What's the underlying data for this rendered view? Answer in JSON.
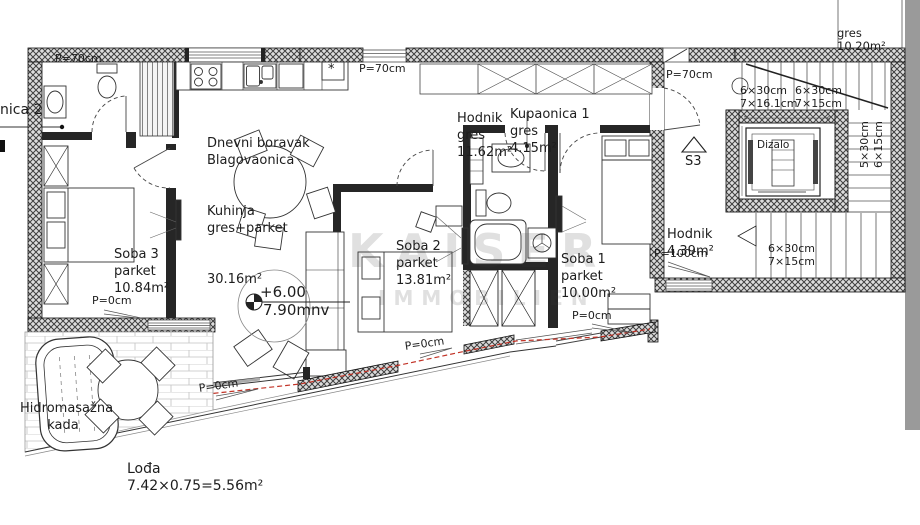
{
  "labels": {
    "neighbor_partial": "nica 2",
    "p70_a": "P=70cm",
    "p70_b": "P=70cm",
    "p70_c": "P=70cm",
    "living": [
      "Dnevni boravak",
      "Blagovaonica",
      "Kuhinja",
      "gres+parket",
      "30.16m²"
    ],
    "hodnik1": [
      "Hodnik",
      "gres",
      "11.62m²"
    ],
    "kupaonica": [
      "Kupaonica 1",
      "gres",
      "4.15m²"
    ],
    "soba1": [
      "Soba 1",
      "parket",
      "10.00m²"
    ],
    "soba2": [
      "Soba 2",
      "parket",
      "13.81m²"
    ],
    "soba3": [
      "Soba 3",
      "parket",
      "10.84m²"
    ],
    "hodnik2": [
      "Hodnik",
      "4.39m²"
    ],
    "gres_top": [
      "gres",
      "10.20m²"
    ],
    "stairs_top_left": [
      "6×30cm",
      "7×16.1cm"
    ],
    "stairs_top_right": [
      "6×30cm",
      "7×15cm"
    ],
    "stairs_side_vertical": [
      "5×30cm",
      "6×15cm"
    ],
    "stairs_bottom": [
      "6×30cm",
      "7×15cm"
    ],
    "dizalo": "Dizalo",
    "s3": "S3",
    "p100": "P=100cm",
    "p0_soba3": "P=0cm",
    "p0_loda_door": "P=0cm",
    "p0_diagonal": "P=0cm",
    "p0_soba1": "P=0cm",
    "level_top": "+6.00",
    "level_bottom": "7.90mnv",
    "hidro": [
      "Hidromasažna",
      "kada"
    ],
    "loda": [
      "Lođa",
      "7.42×0.75=5.56m²"
    ],
    "kitchen_star": "*"
  },
  "watermark": [
    "KAISER",
    "IMMOBILIEN"
  ],
  "colors": {
    "wall": "#3f3f3f",
    "wall_bg": "#dcdcdc",
    "interior_wall": "#262626",
    "red_accent": "#c23327",
    "gray_band": "#9a9a9a",
    "tile_line": "#c2c2c2"
  }
}
